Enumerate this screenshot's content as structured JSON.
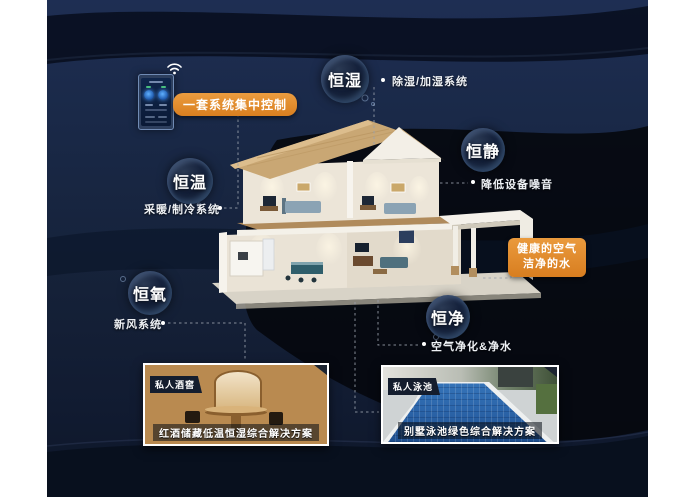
{
  "colors": {
    "background_navy": "#16233f",
    "accent_orange": "#e0892c",
    "text_light": "#f2f4f7"
  },
  "control": {
    "badge": "一套系统集中控制"
  },
  "info_box": {
    "line1": "健康的空气",
    "line2": "洁净的水"
  },
  "bubbles": [
    {
      "id": "humidity",
      "label": "恒湿",
      "note": "除湿/加湿系统"
    },
    {
      "id": "quiet",
      "label": "恒静",
      "note": "降低设备噪音"
    },
    {
      "id": "temperature",
      "label": "恒温",
      "note": "采暖/制冷系统"
    },
    {
      "id": "oxygen",
      "label": "恒氧",
      "note": "新风系统"
    },
    {
      "id": "purity",
      "label": "恒净",
      "note": "空气净化&净水"
    }
  ],
  "photos": [
    {
      "id": "wine-cellar",
      "badge": "私人酒窖",
      "caption": "红酒储藏低温恒湿综合解决方案"
    },
    {
      "id": "pool",
      "badge": "私人泳池",
      "caption": "别墅泳池绿色综合解决方案"
    }
  ]
}
